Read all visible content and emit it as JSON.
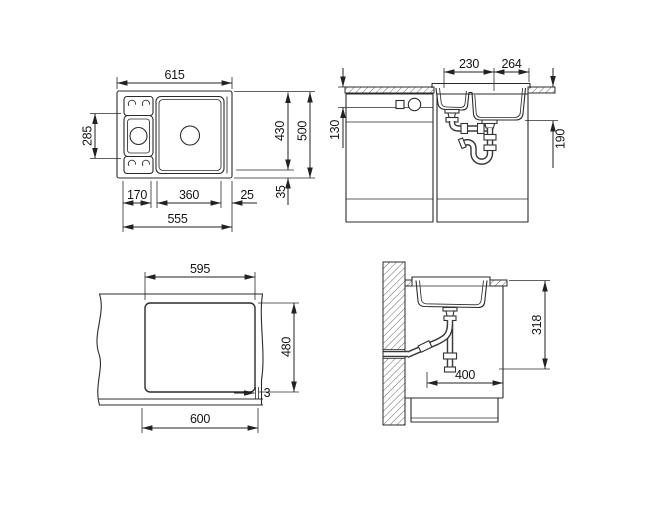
{
  "page": {
    "background": "#ffffff",
    "line_color": "#2b2b2b",
    "text_color": "#151515"
  },
  "drawings": {
    "top_view": {
      "label": "sink top view",
      "dims": {
        "total_width": "615",
        "total_height": "500",
        "bowl_area_height": "430",
        "small_bowl_length": "285",
        "small_bowl_width": "170",
        "main_bowl_width": "360",
        "right_offset": "25",
        "bowls_width": "555",
        "bottom_offset": "35"
      }
    },
    "front_view": {
      "label": "front section with cabinets",
      "dims": {
        "small_bowl_top_width": "230",
        "main_bowl_top_width": "264",
        "small_bowl_depth": "130",
        "main_bowl_depth": "190"
      }
    },
    "cutout_view": {
      "label": "worktop cutout template",
      "dims": {
        "cutout_width": "595",
        "cutout_height": "480",
        "sink_base_width": "600",
        "edge_gap": "3"
      }
    },
    "side_view": {
      "label": "side section at wall",
      "dims": {
        "drain_outlet_height": "318",
        "cabinet_depth": "400"
      }
    }
  }
}
